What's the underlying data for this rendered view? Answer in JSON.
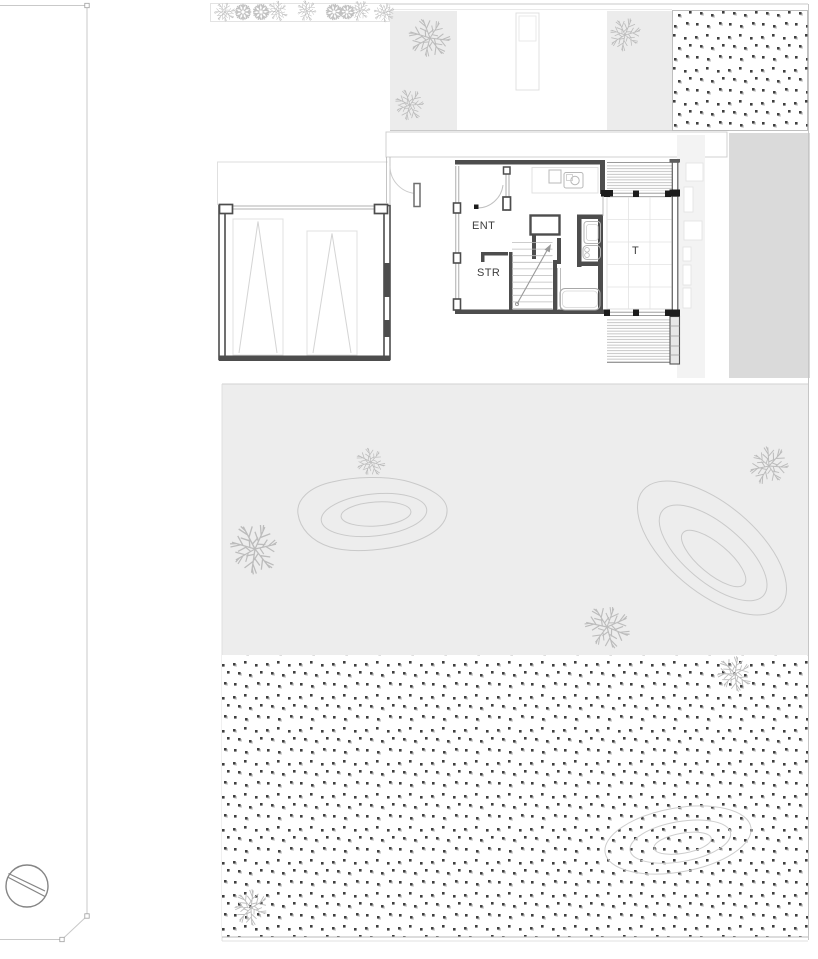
{
  "plan": {
    "rooms": [
      {
        "id": "entrance",
        "label": "ENT"
      },
      {
        "id": "storage",
        "label": "STR"
      },
      {
        "id": "tatami-room",
        "label": "T"
      }
    ]
  },
  "colors": {
    "wall": "#4d4d4d",
    "black_post": "#1c1c1c",
    "thin_line": "#c6c6c6",
    "deck_hatch": "#ababab",
    "courtyard_fill": "#ededed",
    "garden_strip_fill": "#ececec",
    "neighbor_band_fill": "#dadada",
    "stone_strip_fill": "#f3f3f3",
    "stipple_dot": "#3f3f3f"
  },
  "icons": {
    "tree": "tree-icon",
    "shrub": "shrub-icon",
    "survey_marker": "survey-marker-icon"
  }
}
